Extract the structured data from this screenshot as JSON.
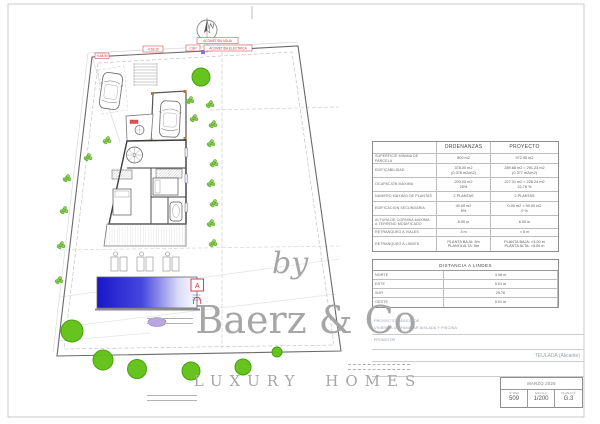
{
  "plan": {
    "compass_label": "N",
    "marker_a": "A",
    "annotation_tags": [
      {
        "x": 95,
        "y": 53,
        "w": 14,
        "h": 5.5,
        "text": "+168.90",
        "color": "#cc3333"
      },
      {
        "x": 143,
        "y": 46,
        "w": 20,
        "h": 6,
        "text": "+169.16",
        "color": "#cc3333"
      },
      {
        "x": 197,
        "y": 37.5,
        "w": 41,
        "h": 6,
        "text": "ACOMETIDA AGUA",
        "color": "#cc3333"
      },
      {
        "x": 186,
        "y": 45,
        "w": 14,
        "h": 6,
        "text": "CGP",
        "color": "#cc3333"
      },
      {
        "x": 204,
        "y": 45,
        "w": 48,
        "h": 6,
        "text": "ACOMETIDA ELECTRICA",
        "color": "#cc3333"
      }
    ],
    "trees": [
      [
        201,
        77,
        9
      ],
      [
        72,
        331,
        11
      ],
      [
        103,
        360,
        10
      ],
      [
        137,
        369,
        9.5
      ],
      [
        191,
        371,
        9
      ],
      [
        243,
        367,
        8
      ],
      [
        277,
        352,
        5
      ]
    ],
    "bushes": [
      [
        107,
        140
      ],
      [
        88,
        157
      ],
      [
        67,
        178
      ],
      [
        64,
        210
      ],
      [
        61,
        245
      ],
      [
        59,
        280
      ],
      [
        190,
        100
      ],
      [
        194,
        118
      ],
      [
        210,
        104
      ],
      [
        213,
        124
      ],
      [
        211,
        143
      ],
      [
        214,
        163
      ],
      [
        211,
        183
      ],
      [
        214,
        203
      ],
      [
        211,
        223
      ],
      [
        213,
        243
      ]
    ],
    "colors": {
      "tree_fill": "#5fc113",
      "tree_stroke": "#3f9d00",
      "pool_dark": "#1717c9",
      "pool_light": "#fbfbff",
      "annotation_red": "#cc3333",
      "shrub_purple": "#b9a7dc"
    }
  },
  "watermark": {
    "by": "by",
    "brand": "Baerz & Co",
    "tagline": "LUXURY HOMES"
  },
  "ordinances_table": {
    "headers": {
      "ordenanzas": "ORDENANZAS",
      "proyecto": "PROYECTO"
    },
    "rows": [
      {
        "label": "SUPERFICIE MINIMA DE PARCELA",
        "ordenanzas": "800 m2",
        "proyecto": "972.95 m2"
      },
      {
        "label": "EDIFICABILIDAD",
        "ordenanzas": "378.00 m2\n(0.378 m2/m2)",
        "proyecto": "289.68 m2 < 291.23 m2\n(0.377 m2/m2)"
      },
      {
        "label": "OCUPACIÓN MÁXIMA",
        "ordenanzas": "200.00 m2\n25%",
        "proyecto": "227.01 m2 < 228.24 m2\n22.76 %"
      },
      {
        "label": "NUMERO MAXIMO DE PLANTAS",
        "ordenanzas": "2 PLANTAS",
        "proyecto": "2 PLANTAS"
      },
      {
        "label": "EDIFICACION SECUNDARIA",
        "ordenanzas": "40.00 m2\n5%",
        "proyecto": "0.00 m2 < 50.00 m2\n0 %"
      },
      {
        "label": "ALTURA DE CORNISA MAXIMA\nA TERRENO MODIFICADO",
        "ordenanzas": "8.50 m",
        "proyecto": "6.00 m"
      },
      {
        "label": "RETRANQUEO A VIALES",
        "ordenanzas": "3 m",
        "proyecto": "> 5 m"
      },
      {
        "label": "RETRANQUEO A LINDES",
        "ordenanzas": "PLANTA BAJA: 3m\nPLANTA ALTA: 5m",
        "proyecto": "PLANTA BAJA: >3.00 m\nPLANTA ALTA: >5.00 m"
      }
    ]
  },
  "distances_table": {
    "title": "DISTANCIA A LINDES",
    "rows": [
      {
        "label": "NORTE",
        "value": "3.38 m"
      },
      {
        "label": "ESTE",
        "value": "5.01 m"
      },
      {
        "label": "SUR",
        "value": "29.76"
      },
      {
        "label": "OESTE",
        "value": "5.01 m"
      }
    ]
  },
  "title_block": {
    "project_line1": "PROYECTO BÁSICO DE",
    "project_line2": "VIVIENDA UNIFAMILIAR AISLADA Y PISCINA",
    "promotor_label": "PROMOTOR",
    "location": "TEULADA (Alicante)",
    "date": "MARZO 2025",
    "ref_label": "Nº REF",
    "ref_value": "509",
    "scale_label": "ESCALA",
    "scale_value": "1/200",
    "sheet_label": "PLANO Nº",
    "sheet_value": "G.3"
  }
}
